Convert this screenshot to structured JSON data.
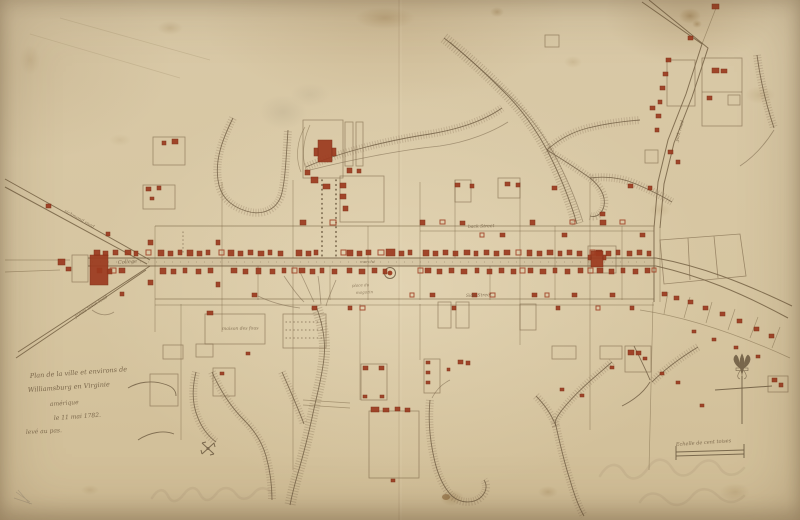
{
  "palette": {
    "paper": "#d8c7a3",
    "ink_sepia": "#6b5940",
    "building_red": "#9c3a1f",
    "creek_hatch": "#8a7458"
  },
  "cartouche": {
    "line1": "Plan de la ville et environs de",
    "line2": "Williamsburg en Virginie",
    "line3": "amérique",
    "line4": "le 11 mai 1782.",
    "line5": "levé au pas."
  },
  "scale_bar": {
    "label": "Echelle de cent toises"
  },
  "labels": [
    {
      "id": "college",
      "t": "College",
      "x": 118,
      "y": 264,
      "s": 5,
      "r": -4,
      "o": 0.8
    },
    {
      "id": "market",
      "t": "marché",
      "x": 360,
      "y": 263,
      "s": 4,
      "r": 0,
      "o": 0.7
    },
    {
      "id": "magazine-1",
      "t": "place du",
      "x": 352,
      "y": 287,
      "s": 4,
      "r": -3,
      "o": 0.7
    },
    {
      "id": "magazine-2",
      "t": "magazin",
      "x": 356,
      "y": 294,
      "s": 4,
      "r": -3,
      "o": 0.7
    },
    {
      "id": "back-street",
      "t": "back Street",
      "x": 468,
      "y": 228,
      "s": 4.5,
      "r": -2,
      "o": 0.75
    },
    {
      "id": "side-street",
      "t": "Side Street",
      "x": 466,
      "y": 297,
      "s": 4.5,
      "r": -2,
      "o": 0.75
    },
    {
      "id": "maison-des-fous",
      "t": "maison des fous",
      "x": 222,
      "y": 330,
      "s": 4.5,
      "r": -1,
      "o": 0.75
    },
    {
      "id": "york-road",
      "t": "york road",
      "x": 678,
      "y": 142,
      "s": 4.5,
      "r": -75,
      "o": 0.75
    },
    {
      "id": "richmond-road",
      "t": "richmond road",
      "x": 64,
      "y": 212,
      "s": 4.5,
      "r": 29,
      "o": 0.7
    },
    {
      "id": "jamestown-road",
      "t": "james town road",
      "x": 76,
      "y": 318,
      "s": 4.5,
      "r": -33,
      "o": 0.7
    }
  ],
  "map": {
    "buildings_filled": [
      [
        94,
        250,
        6,
        6
      ],
      [
        103,
        251,
        5,
        5
      ],
      [
        113,
        250,
        5,
        5
      ],
      [
        125,
        250,
        6,
        5
      ],
      [
        134,
        251,
        4,
        5
      ],
      [
        158,
        250,
        6,
        6
      ],
      [
        168,
        251,
        5,
        5
      ],
      [
        178,
        250,
        4,
        5
      ],
      [
        187,
        250,
        6,
        6
      ],
      [
        197,
        251,
        5,
        5
      ],
      [
        206,
        250,
        4,
        5
      ],
      [
        228,
        250,
        6,
        6
      ],
      [
        238,
        251,
        5,
        5
      ],
      [
        248,
        250,
        5,
        5
      ],
      [
        258,
        251,
        6,
        5
      ],
      [
        268,
        250,
        4,
        5
      ],
      [
        278,
        251,
        5,
        5
      ],
      [
        296,
        250,
        6,
        6
      ],
      [
        306,
        251,
        5,
        5
      ],
      [
        314,
        250,
        4,
        5
      ],
      [
        347,
        250,
        6,
        6
      ],
      [
        357,
        251,
        5,
        5
      ],
      [
        366,
        250,
        5,
        5
      ],
      [
        386,
        249,
        9,
        7
      ],
      [
        399,
        251,
        5,
        5
      ],
      [
        408,
        250,
        4,
        5
      ],
      [
        423,
        250,
        6,
        6
      ],
      [
        433,
        251,
        5,
        5
      ],
      [
        443,
        250,
        5,
        5
      ],
      [
        453,
        251,
        5,
        5
      ],
      [
        464,
        250,
        6,
        5
      ],
      [
        474,
        251,
        4,
        5
      ],
      [
        484,
        250,
        5,
        5
      ],
      [
        494,
        251,
        5,
        5
      ],
      [
        504,
        250,
        6,
        5
      ],
      [
        527,
        250,
        5,
        6
      ],
      [
        537,
        251,
        5,
        5
      ],
      [
        547,
        250,
        6,
        5
      ],
      [
        558,
        251,
        4,
        5
      ],
      [
        567,
        250,
        5,
        5
      ],
      [
        577,
        251,
        5,
        5
      ],
      [
        596,
        250,
        6,
        6
      ],
      [
        606,
        251,
        5,
        5
      ],
      [
        616,
        250,
        4,
        5
      ],
      [
        627,
        251,
        5,
        5
      ],
      [
        637,
        250,
        5,
        5
      ],
      [
        647,
        251,
        4,
        5
      ],
      [
        97,
        268,
        5,
        5
      ],
      [
        107,
        269,
        5,
        5
      ],
      [
        119,
        268,
        6,
        5
      ],
      [
        160,
        268,
        6,
        6
      ],
      [
        171,
        269,
        5,
        5
      ],
      [
        183,
        268,
        4,
        5
      ],
      [
        196,
        269,
        5,
        5
      ],
      [
        208,
        268,
        5,
        5
      ],
      [
        231,
        268,
        6,
        5
      ],
      [
        243,
        269,
        5,
        5
      ],
      [
        256,
        268,
        5,
        6
      ],
      [
        270,
        269,
        5,
        5
      ],
      [
        282,
        268,
        4,
        5
      ],
      [
        299,
        268,
        6,
        5
      ],
      [
        310,
        269,
        5,
        5
      ],
      [
        320,
        268,
        4,
        5
      ],
      [
        332,
        269,
        5,
        5
      ],
      [
        347,
        268,
        5,
        5
      ],
      [
        359,
        269,
        6,
        5
      ],
      [
        372,
        268,
        5,
        5
      ],
      [
        383,
        269,
        4,
        5
      ],
      [
        425,
        268,
        6,
        5
      ],
      [
        437,
        269,
        5,
        5
      ],
      [
        449,
        268,
        5,
        5
      ],
      [
        461,
        269,
        6,
        5
      ],
      [
        475,
        268,
        4,
        5
      ],
      [
        487,
        269,
        5,
        5
      ],
      [
        499,
        268,
        5,
        5
      ],
      [
        511,
        269,
        5,
        5
      ],
      [
        528,
        268,
        5,
        5
      ],
      [
        540,
        269,
        6,
        5
      ],
      [
        553,
        268,
        4,
        5
      ],
      [
        565,
        269,
        5,
        5
      ],
      [
        578,
        268,
        5,
        5
      ],
      [
        597,
        268,
        6,
        5
      ],
      [
        609,
        269,
        5,
        5
      ],
      [
        621,
        268,
        4,
        5
      ],
      [
        633,
        269,
        5,
        5
      ],
      [
        645,
        268,
        5,
        5
      ],
      [
        300,
        220,
        6,
        5
      ],
      [
        340,
        183,
        6,
        5
      ],
      [
        340,
        194,
        6,
        5
      ],
      [
        343,
        206,
        5,
        5
      ],
      [
        420,
        220,
        5,
        5
      ],
      [
        460,
        221,
        5,
        4
      ],
      [
        500,
        233,
        5,
        4
      ],
      [
        530,
        220,
        5,
        5
      ],
      [
        562,
        233,
        5,
        4
      ],
      [
        600,
        220,
        6,
        5
      ],
      [
        640,
        233,
        5,
        4
      ],
      [
        455,
        183,
        5,
        4
      ],
      [
        470,
        184,
        4,
        4
      ],
      [
        505,
        182,
        5,
        4
      ],
      [
        516,
        183,
        4,
        4
      ],
      [
        552,
        186,
        5,
        4
      ],
      [
        600,
        212,
        5,
        4
      ],
      [
        628,
        184,
        5,
        4
      ],
      [
        648,
        186,
        4,
        4
      ],
      [
        252,
        293,
        5,
        4
      ],
      [
        312,
        306,
        5,
        4
      ],
      [
        348,
        306,
        4,
        4
      ],
      [
        430,
        293,
        5,
        4
      ],
      [
        452,
        306,
        4,
        4
      ],
      [
        472,
        293,
        5,
        4
      ],
      [
        532,
        293,
        5,
        4
      ],
      [
        556,
        306,
        4,
        4
      ],
      [
        572,
        293,
        5,
        4
      ],
      [
        610,
        293,
        5,
        4
      ],
      [
        630,
        306,
        4,
        4
      ],
      [
        148,
        240,
        5,
        5
      ],
      [
        148,
        280,
        5,
        5
      ],
      [
        216,
        240,
        4,
        5
      ],
      [
        216,
        282,
        4,
        5
      ],
      [
        90,
        255,
        18,
        30
      ],
      [
        58,
        259,
        7,
        6
      ],
      [
        66,
        267,
        5,
        4
      ],
      [
        46,
        204,
        5,
        4
      ],
      [
        106,
        232,
        4,
        4
      ],
      [
        120,
        292,
        4,
        4
      ],
      [
        318,
        140,
        14,
        22
      ],
      [
        314,
        148,
        4,
        8
      ],
      [
        332,
        148,
        4,
        8
      ],
      [
        311,
        177,
        7,
        6
      ],
      [
        323,
        184,
        7,
        5
      ],
      [
        305,
        170,
        5,
        5
      ],
      [
        347,
        168,
        5,
        5
      ],
      [
        357,
        169,
        4,
        4
      ],
      [
        172,
        139,
        6,
        5
      ],
      [
        162,
        141,
        4,
        4
      ],
      [
        146,
        187,
        5,
        4
      ],
      [
        157,
        186,
        4,
        4
      ],
      [
        150,
        197,
        4,
        3
      ],
      [
        712,
        68,
        7,
        5
      ],
      [
        721,
        69,
        6,
        4
      ],
      [
        707,
        96,
        5,
        4
      ],
      [
        650,
        106,
        5,
        4
      ],
      [
        712,
        4,
        7,
        5
      ],
      [
        688,
        36,
        5,
        4
      ],
      [
        666,
        58,
        5,
        4
      ],
      [
        663,
        72,
        5,
        4
      ],
      [
        660,
        86,
        5,
        4
      ],
      [
        658,
        100,
        4,
        4
      ],
      [
        656,
        114,
        5,
        4
      ],
      [
        655,
        128,
        4,
        4
      ],
      [
        668,
        150,
        5,
        4
      ],
      [
        676,
        160,
        4,
        4
      ],
      [
        591,
        251,
        12,
        16
      ],
      [
        588,
        255,
        3,
        5
      ],
      [
        603,
        255,
        3,
        5
      ],
      [
        662,
        292,
        5,
        4
      ],
      [
        674,
        296,
        5,
        4
      ],
      [
        688,
        300,
        5,
        4
      ],
      [
        703,
        306,
        5,
        4
      ],
      [
        720,
        312,
        5,
        4
      ],
      [
        737,
        319,
        5,
        4
      ],
      [
        754,
        327,
        5,
        4
      ],
      [
        769,
        334,
        5,
        4
      ],
      [
        692,
        330,
        4,
        3
      ],
      [
        712,
        338,
        4,
        3
      ],
      [
        734,
        346,
        4,
        3
      ],
      [
        756,
        355,
        4,
        3
      ],
      [
        772,
        378,
        5,
        4
      ],
      [
        779,
        383,
        4,
        4
      ],
      [
        371,
        407,
        8,
        5
      ],
      [
        383,
        408,
        6,
        4
      ],
      [
        395,
        407,
        5,
        4
      ],
      [
        405,
        408,
        5,
        4
      ],
      [
        391,
        479,
        4,
        3
      ],
      [
        363,
        366,
        5,
        4
      ],
      [
        379,
        366,
        5,
        4
      ],
      [
        363,
        395,
        4,
        3
      ],
      [
        380,
        395,
        4,
        3
      ],
      [
        426,
        361,
        4,
        3
      ],
      [
        426,
        371,
        4,
        3
      ],
      [
        426,
        381,
        4,
        3
      ],
      [
        458,
        360,
        5,
        4
      ],
      [
        466,
        361,
        4,
        4
      ],
      [
        447,
        368,
        3,
        3
      ],
      [
        628,
        350,
        6,
        5
      ],
      [
        636,
        351,
        5,
        4
      ],
      [
        643,
        357,
        4,
        3
      ],
      [
        610,
        366,
        4,
        3
      ],
      [
        660,
        372,
        4,
        3
      ],
      [
        676,
        381,
        4,
        3
      ],
      [
        700,
        404,
        4,
        3
      ],
      [
        207,
        311,
        6,
        4
      ],
      [
        246,
        352,
        4,
        3
      ],
      [
        220,
        372,
        4,
        3
      ],
      [
        560,
        388,
        4,
        3
      ],
      [
        580,
        394,
        4,
        3
      ]
    ],
    "buildings_outline": [
      [
        110,
        268,
        6,
        5
      ],
      [
        146,
        250,
        5,
        5
      ],
      [
        219,
        250,
        5,
        5
      ],
      [
        292,
        268,
        5,
        5
      ],
      [
        341,
        250,
        5,
        5
      ],
      [
        378,
        250,
        6,
        5
      ],
      [
        418,
        268,
        5,
        5
      ],
      [
        516,
        250,
        5,
        5
      ],
      [
        520,
        268,
        5,
        5
      ],
      [
        588,
        268,
        5,
        5
      ],
      [
        590,
        250,
        5,
        5
      ],
      [
        652,
        268,
        4,
        4
      ],
      [
        330,
        220,
        6,
        5
      ],
      [
        440,
        220,
        5,
        4
      ],
      [
        480,
        233,
        4,
        4
      ],
      [
        570,
        220,
        5,
        4
      ],
      [
        620,
        220,
        5,
        4
      ],
      [
        360,
        306,
        5,
        4
      ],
      [
        410,
        293,
        4,
        4
      ],
      [
        490,
        293,
        5,
        4
      ],
      [
        545,
        293,
        4,
        4
      ],
      [
        596,
        306,
        4,
        4
      ]
    ]
  }
}
